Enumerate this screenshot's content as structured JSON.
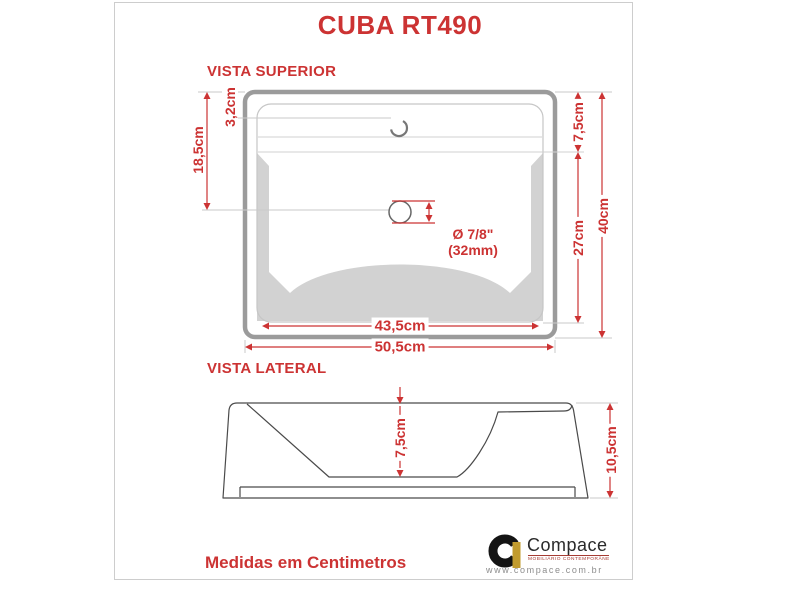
{
  "title": "CUBA RT490",
  "top_view": {
    "label": "VISTA SUPERIOR",
    "dim_left_total": "18,5cm",
    "dim_faucet_offset": "3,2cm",
    "dim_deck_depth": "7,5cm",
    "dim_basin_depth": "27cm",
    "dim_height_total": "40cm",
    "dim_inner_width": "43,5cm",
    "dim_outer_width": "50,5cm",
    "drain_diameter": "Ø 7/8\"",
    "drain_diameter_mm": "(32mm)"
  },
  "side_view": {
    "label": "VISTA LATERAL",
    "dim_basin_depth": "7,5cm",
    "dim_total_height": "10,5cm"
  },
  "footer": {
    "units_note": "Medidas em Centimetros"
  },
  "logo": {
    "brand": "Compace",
    "tagline": "MOBILIÁRIO CONTEMPORÂNEO",
    "website": "www.compace.com.br"
  },
  "colors": {
    "accent": "#cc3333",
    "drawing_gray": "#9b9b9b",
    "shadow_gray": "#d2d2d2",
    "logo_gold": "#c19b2e"
  }
}
